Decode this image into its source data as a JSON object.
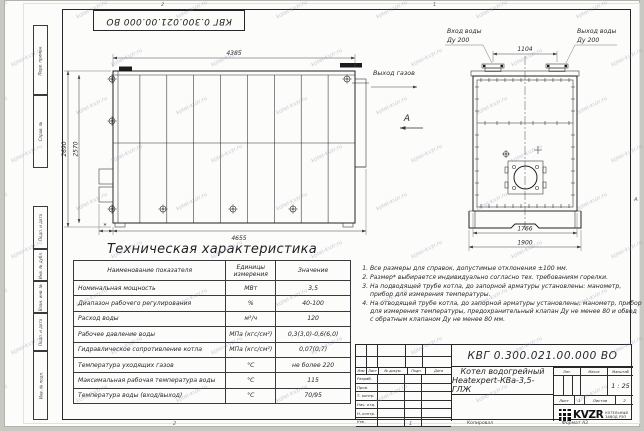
{
  "sheet": {
    "doc_number": "КВГ 0.300.021.00.000 ВО",
    "zones": {
      "top_left": "2",
      "top_right": "1",
      "bottom_left": "2",
      "bottom_right": "1",
      "right_middle": "А"
    },
    "copied": "Копировал",
    "format": "Формат А3"
  },
  "side_stamps": [
    "Перв. примен.",
    "Справ. №",
    "Подп. и дата",
    "Инв. № дубл.",
    "Взам. инв. №",
    "Подп. и дата",
    "Инв. № подл."
  ],
  "left_view": {
    "dim_top": "4385",
    "dim_bottom": "4655",
    "dim_height_outer": "2690",
    "dim_height_inner": "2570",
    "dim_star": "*",
    "gas_outlet": "Выход газов",
    "view_label": "А"
  },
  "front_view": {
    "inlet_line1": "Вход воды",
    "inlet_line2": "Ду 200",
    "outlet_line1": "Выход воды",
    "outlet_line2": "Ду 200",
    "dim_nozzles": "1104",
    "dim_body": "1766",
    "dim_base": "1900"
  },
  "spec": {
    "title": "Техническая характеристика",
    "headers": [
      "Наименование показателя",
      "Единицы измерения",
      "Значение"
    ],
    "rows": [
      [
        "Номинальная мощность",
        "МВт",
        "3,5"
      ],
      [
        "Диапазон рабочего регулирования",
        "%",
        "40-100"
      ],
      [
        "Расход воды",
        "м³/ч",
        "120"
      ],
      [
        "Рабочее давление воды",
        "МПа (кгс/см²)",
        "0,3(3,0)-0,6(6,0)"
      ],
      [
        "Гидравлическое сопротивление котла",
        "МПа (кгс/см²)",
        "0,07(0,7)"
      ],
      [
        "Температура уходящих газов",
        "°С",
        "не более 220"
      ],
      [
        "Максимальная рабочая температура воды",
        "°С",
        "115"
      ],
      [
        "Температура воды (вход/выход)",
        "°С",
        "70/95"
      ]
    ]
  },
  "notes": [
    "Все размеры для справок, допустимые отклонения ±100 мм.",
    "Размер* выбирается индивидуально согласно тех. требованиям горелки.",
    "На подводящей трубе котла, до запорной арматуры установлены: манометр, прибор для измерения температуры.",
    "На отводящей трубе котла, до запорной арматуры установлены: манометр, прибор для измерения температуры, предохранительный клапан Ду не менее 80 и обвод с обратным клапаном Ду не менее 80 мм."
  ],
  "title_block": {
    "doc_number": "КВГ 0.300.021.00.000 ВО",
    "change_cols": [
      "Изм",
      "Лист",
      "№ докум.",
      "Подп.",
      "Дата"
    ],
    "sign_rows": [
      "Разраб.",
      "Пров.",
      "Т. контр.",
      "Нач. отд.",
      "Н. контр.",
      "Утв."
    ],
    "product_line1": "Котел водогрейный",
    "product_line2": "Heatexpert-КВа-3,5-ГЛЖ",
    "lit_label": "Лит.",
    "mass_label": "Масса",
    "scale_label": "Масштаб",
    "scale_value": "1 : 25",
    "sheet_label": "Лист",
    "sheet_value": "1",
    "sheets_label": "Листов",
    "sheets_value": "2",
    "brand": "KVZR",
    "company_line1": "КОТЕЛЬНЫЙ",
    "company_line2": "ЗАВОД РЭП"
  },
  "watermark": {
    "text": "kotel-kvzr.ru"
  },
  "colors": {
    "line": "#26262a",
    "paper": "#fcfcfa",
    "watermark": "#7d91a5"
  }
}
